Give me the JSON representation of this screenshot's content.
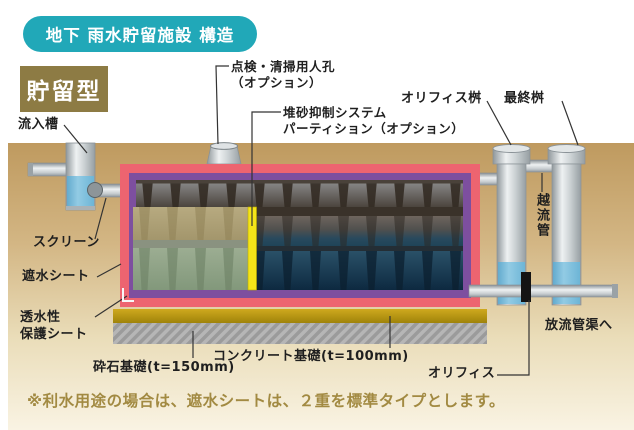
{
  "header": {
    "title_badge": "地下 雨水貯留施設 構造",
    "type_label": "貯留型"
  },
  "labels": {
    "inflow_tank": "流入槽",
    "manhole_line1": "点検・清掃用人孔",
    "manhole_line2": "（オプション）",
    "partition_line1": "堆砂抑制システム",
    "partition_line2": "パーティション（オプション）",
    "orifice_basin": "オリフィス桝",
    "final_basin": "最終桝",
    "overflow_pipe": "越流管",
    "screen": "スクリーン",
    "barrier_sheet": "遮水シート",
    "protect_sheet_line1": "透水性",
    "protect_sheet_line2": "保護シート",
    "gravel_base": "砕石基礎(t=150mm)",
    "concrete_base": "コンクリート基礎(t=100mm)",
    "orifice": "オリフィス",
    "discharge": "放流管渠へ"
  },
  "note": "※利水用途の場合は、遮水シートは、２重を標準タイプとします。",
  "colors": {
    "badge_teal": "#21a8b8",
    "type_olive": "#8d7b44",
    "note_gold": "#a28a42",
    "ground_tan": "#bf9a5f",
    "barrier_sheet_pink": "#ed6470",
    "protect_sheet_purple": "#7d4f9f",
    "partition_yellow": "#f4e418",
    "water_blue": "#74b9da",
    "concrete_gold": "#b8960f",
    "gravel_gray": "#9b9b9b"
  }
}
